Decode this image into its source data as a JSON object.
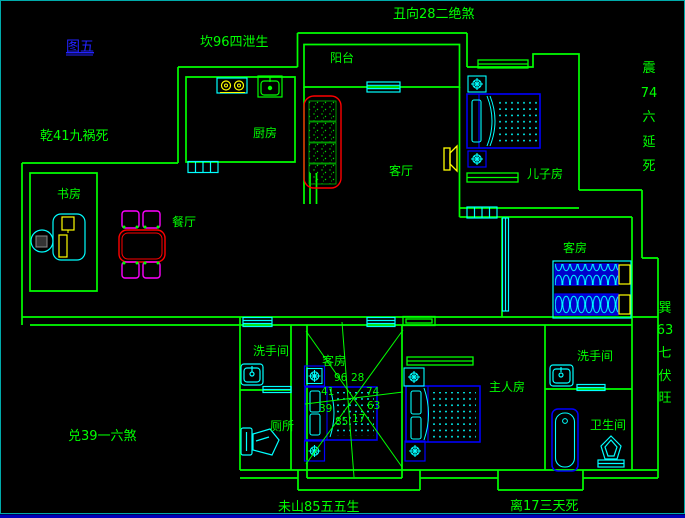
{
  "figure": {
    "label": "图五"
  },
  "perimeter": {
    "top_center": "丑向28二绝煞",
    "upper_left": "坎96四泄生",
    "left": "乾41九祸死",
    "lower_left": "兑39一六煞",
    "bottom_center": "未山85五五生",
    "bottom_right": "离17三天死",
    "right_upper": {
      "chars": [
        "震",
        "74",
        "六",
        "延",
        "死"
      ]
    },
    "right_lower": {
      "chars": [
        "巽",
        "63",
        "七",
        "伏",
        "旺"
      ]
    }
  },
  "rooms": {
    "balcony": "阳台",
    "kitchen": "厨房",
    "living_room": "客厅",
    "sons_room": "儿子房",
    "study": "书房",
    "dining_room": "餐厅",
    "guest_room_upper": "客房",
    "guest_room_lower": "客房",
    "master_bedroom": "主人房",
    "washroom_left": "洗手间",
    "toilet": "厕所",
    "washroom_right": "洗手间",
    "bathroom": "卫生间"
  },
  "compass": {
    "n_left": "96",
    "n_right": "28",
    "nw": "41",
    "ne": "74",
    "w": "39",
    "e": "63",
    "s_left": "85",
    "s_right": "17"
  },
  "colors": {
    "background": "#000000",
    "wall_green": "#00ff00",
    "label_green": "#00ff00",
    "figure_label_blue": "#2222ff",
    "furniture_blue": "#0000ff",
    "detail_cyan": "#00ffff",
    "sofa_red": "#ff0000",
    "chair_magenta": "#ff00ff",
    "accent_yellow": "#ffff00",
    "frame_cyan": "#00aaaa",
    "bottom_bar_blue": "#0000bb"
  }
}
